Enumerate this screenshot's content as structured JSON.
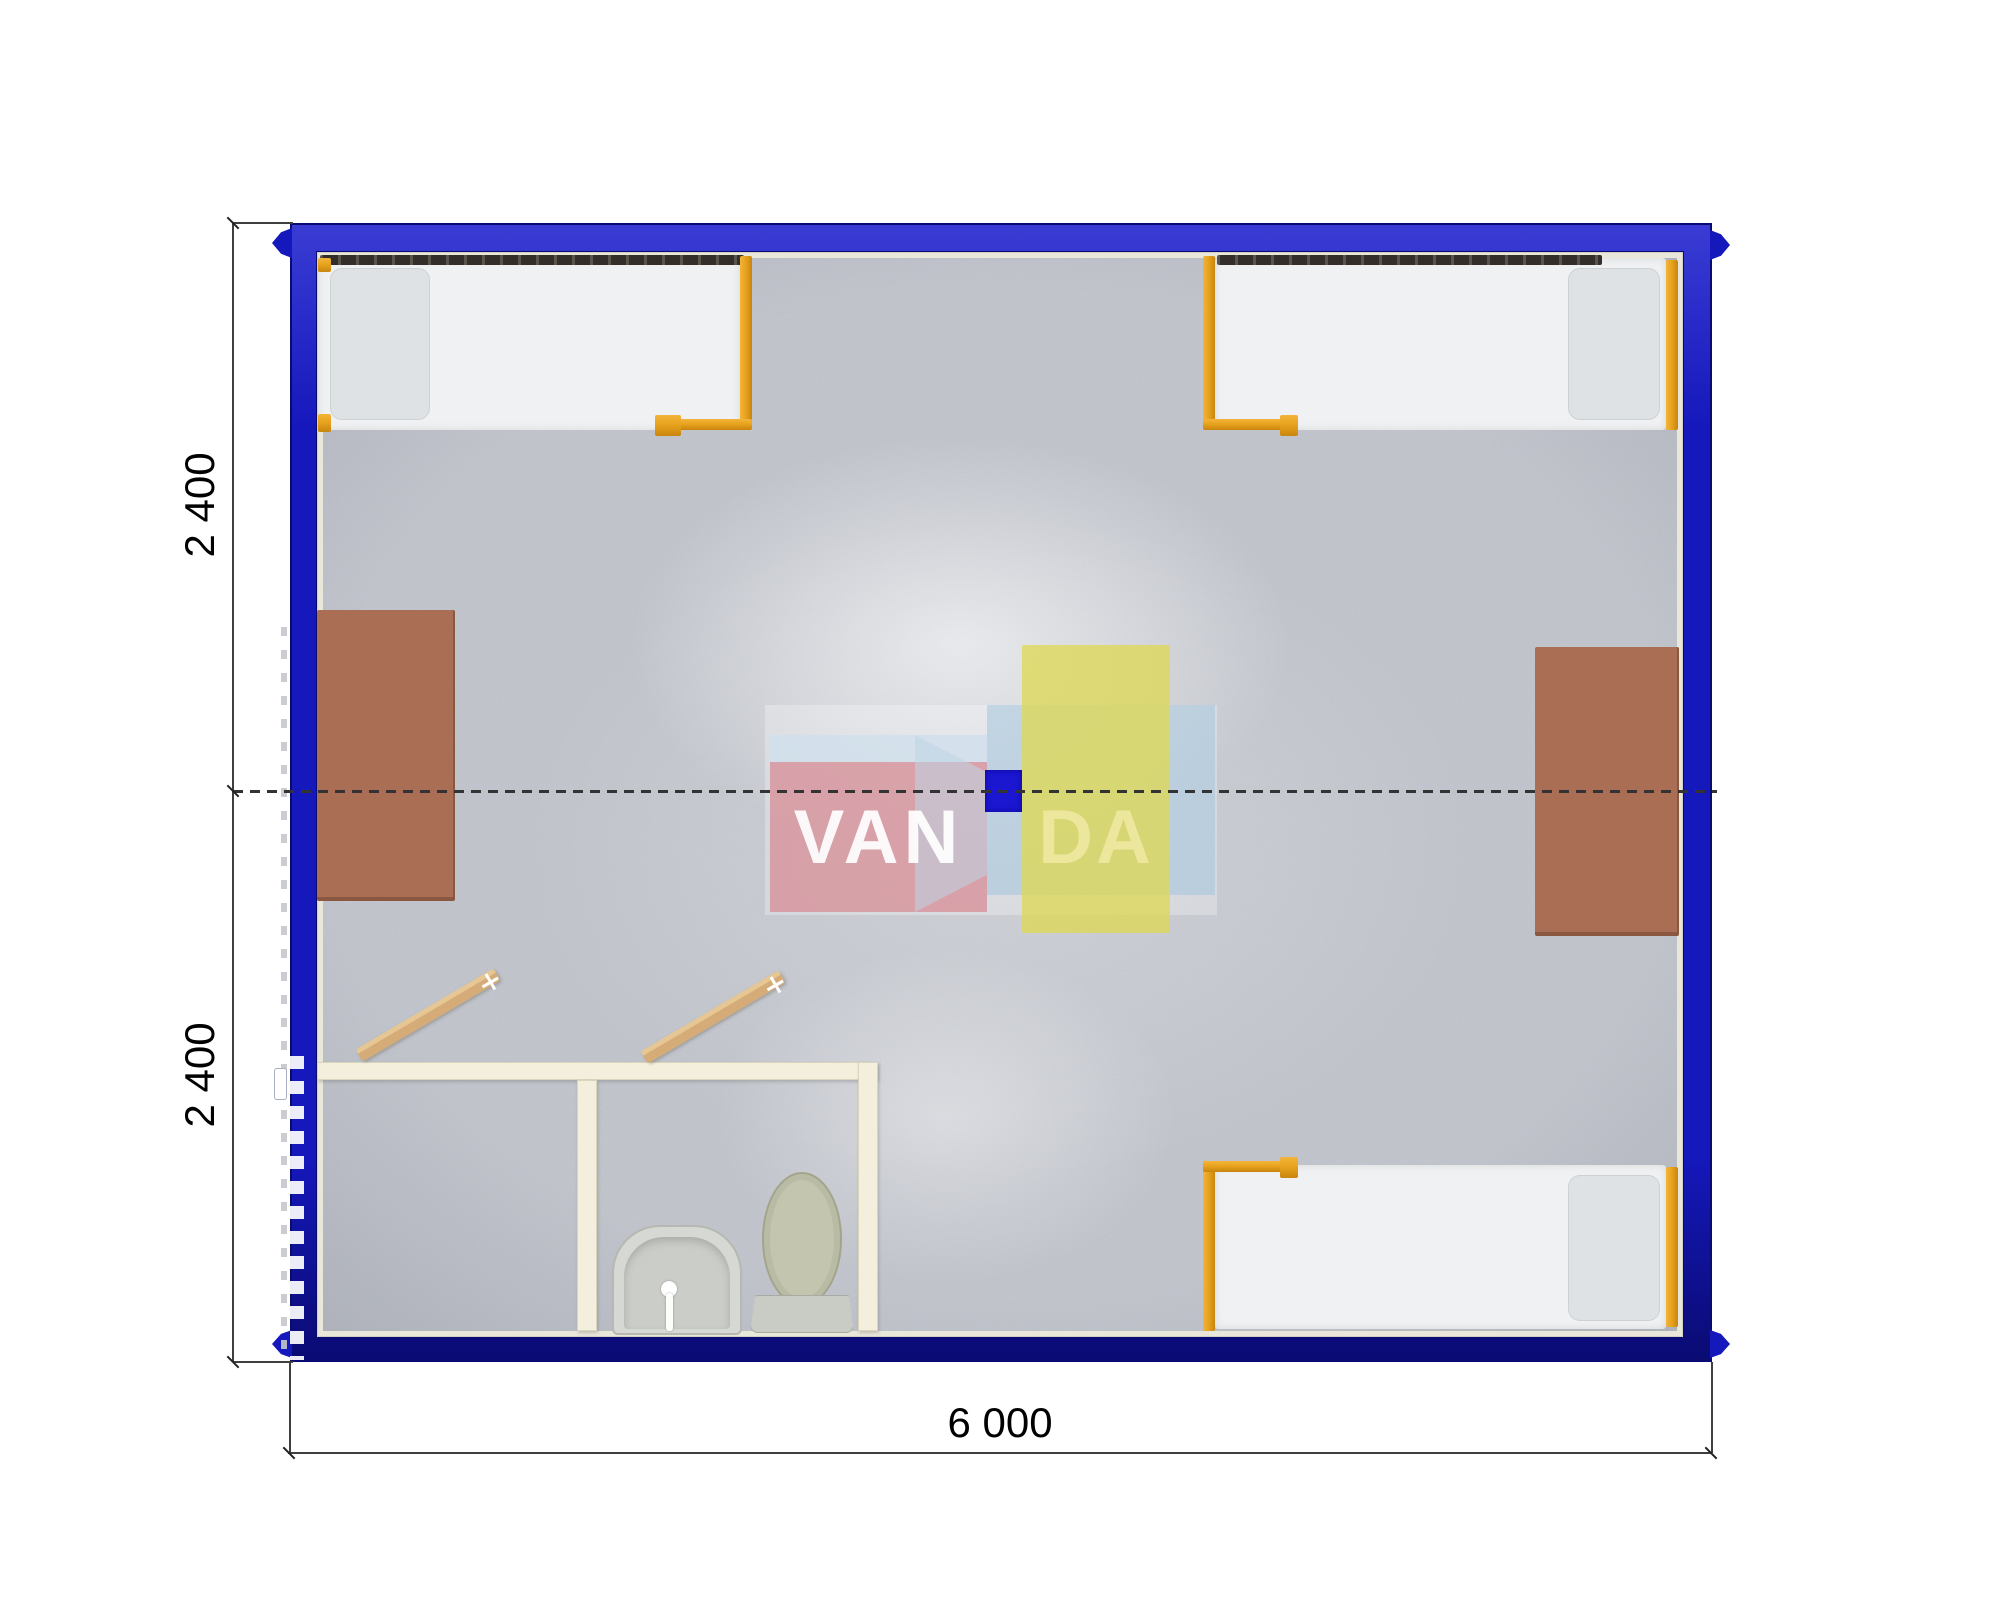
{
  "document": {
    "type": "container-module-floor-plan",
    "brand": "VANDA"
  },
  "watermark": {
    "text_left": "VAN",
    "text_right": "DA",
    "brand": "VANDA"
  },
  "dimensions": {
    "left_upper": "2 400",
    "left_lower": "2 400",
    "bottom_width": "6 000"
  },
  "colors": {
    "frame-blue": "#1518bb",
    "frame-blue-dark": "#0a0b72",
    "frame-blue-light": "#3a3cd4",
    "lining": "#e9e6da",
    "floor-base": "#c5c8cf",
    "bed-orange": "#e8a31e",
    "bed-orange-dark": "#c8860e",
    "mattress": "#f0f1f2",
    "pillow": "#dfe2e4",
    "rail-dark": "#332e29",
    "table-brown": "#a96e54",
    "table-brown-dark": "#8a5741",
    "wall-cream": "#f4efdc",
    "wall-cream-dark": "#d9d4bc",
    "wood": "#d5ac78",
    "toilet-khaki": "#c3c5ae",
    "fixture-gray": "#d6d8d3",
    "logo-pink": "#d7969f",
    "logo-blue": "#a4c4dc",
    "logo-yellow": "#ded856",
    "logo-square": "#1b16d0",
    "dim-color": "#3f3f3f",
    "dash-color": "#333333",
    "handle-white": "#ffffff"
  }
}
